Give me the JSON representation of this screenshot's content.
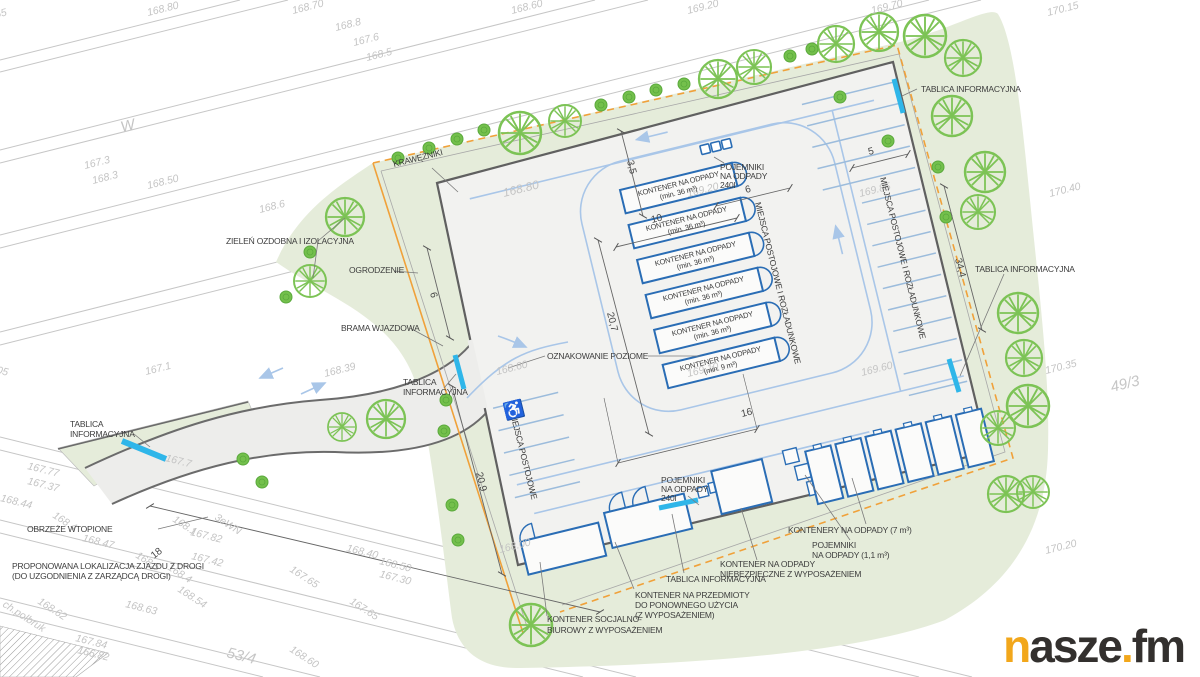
{
  "colors": {
    "green_area": "#e5ecda",
    "tree_stroke": "#7cc355",
    "bush_fill": "#74c04c",
    "yard_fill": "#f2f2f0",
    "driveway_fill": "#ededeb",
    "edge_dark": "#636363",
    "boundary_orange": "#f0a13a",
    "container_blue": "#2a6db5",
    "roadway_blue": "#a9c6e8",
    "stall_blue": "#9cbcdc",
    "sign_cyan": "#2fb6e9",
    "road_gray": "#c6c6c6",
    "elev_gray": "#c4c4c4",
    "ann_dark": "#3d3d3d",
    "logo_orange": "#f2a71b",
    "logo_dark": "#33302e"
  },
  "logo": {
    "n": "n",
    "asze": "asze",
    "dot": ".",
    "fm": "fm"
  },
  "plan": {
    "texts": [
      {
        "t": "65",
        "x": -4,
        "y": 18,
        "r": -14,
        "c": "e"
      },
      {
        "t": "168.80",
        "x": 148,
        "y": 16,
        "r": -14,
        "c": "e"
      },
      {
        "t": "168.70",
        "x": 293,
        "y": 14,
        "r": -14,
        "c": "e"
      },
      {
        "t": "168.8",
        "x": 336,
        "y": 31,
        "r": -14,
        "c": "e"
      },
      {
        "t": "167.6",
        "x": 354,
        "y": 46,
        "r": -14,
        "c": "e"
      },
      {
        "t": "168.5",
        "x": 367,
        "y": 61,
        "r": -14,
        "c": "e"
      },
      {
        "t": "168.60",
        "x": 512,
        "y": 14,
        "r": -14,
        "c": "e"
      },
      {
        "t": "169.20",
        "x": 688,
        "y": 14,
        "r": -14,
        "c": "e"
      },
      {
        "t": "169.70",
        "x": 872,
        "y": 14,
        "r": -14,
        "c": "e"
      },
      {
        "t": "170.15",
        "x": 1048,
        "y": 16,
        "r": -14,
        "c": "e"
      },
      {
        "t": "W",
        "x": 122,
        "y": 132,
        "r": -14,
        "s": 15,
        "c": "e"
      },
      {
        "t": "167.3",
        "x": 85,
        "y": 169,
        "r": -14,
        "c": "e"
      },
      {
        "t": "168.3",
        "x": 93,
        "y": 184,
        "r": -14,
        "c": "e"
      },
      {
        "t": "168.50",
        "x": 148,
        "y": 189,
        "r": -14,
        "c": "e"
      },
      {
        "t": "168.6",
        "x": 260,
        "y": 213,
        "r": -14,
        "c": "e"
      },
      {
        "t": "168.80",
        "x": 504,
        "y": 197,
        "r": -14,
        "s": 12,
        "c": "e"
      },
      {
        "t": "169.20",
        "x": 688,
        "y": 197,
        "r": -14,
        "c": "e"
      },
      {
        "t": "169.85",
        "x": 860,
        "y": 197,
        "r": -14,
        "c": "e"
      },
      {
        "t": "170.40",
        "x": 1050,
        "y": 197,
        "r": -14,
        "c": "e"
      },
      {
        "t": "168.39",
        "x": 325,
        "y": 377,
        "r": -14,
        "c": "e"
      },
      {
        "t": "167.1",
        "x": 146,
        "y": 375,
        "r": -14,
        "c": "e"
      },
      {
        "t": "168.60",
        "x": 497,
        "y": 375,
        "r": -14,
        "c": "e"
      },
      {
        "t": "169.10",
        "x": 688,
        "y": 377,
        "r": -14,
        "c": "e"
      },
      {
        "t": "169.60",
        "x": 862,
        "y": 376,
        "r": -14,
        "c": "e"
      },
      {
        "t": "170.35",
        "x": 1046,
        "y": 374,
        "r": -14,
        "c": "e"
      },
      {
        "t": "49/3",
        "x": 1112,
        "y": 392,
        "r": -14,
        "c": "p"
      },
      {
        "t": "170.20",
        "x": 1046,
        "y": 554,
        "r": -14,
        "c": "e"
      },
      {
        "t": "168.00",
        "x": 500,
        "y": 553,
        "r": -14,
        "c": "e"
      },
      {
        "t": "167.7",
        "x": 165,
        "y": 461,
        "r": 14,
        "c": "e"
      },
      {
        "t": "167.77",
        "x": 27,
        "y": 469,
        "r": 14,
        "c": "e"
      },
      {
        "t": "167.37",
        "x": 27,
        "y": 484,
        "r": 14,
        "c": "e"
      },
      {
        "t": "168.44",
        "x": 0,
        "y": 501,
        "r": 14,
        "c": "e"
      },
      {
        "t": "168.4",
        "x": 52,
        "y": 517,
        "r": 33,
        "c": "e"
      },
      {
        "t": "168.1",
        "x": 172,
        "y": 521,
        "r": 33,
        "c": "e"
      },
      {
        "t": "3eWN",
        "x": 214,
        "y": 519,
        "r": 33,
        "c": "e"
      },
      {
        "t": "167.82",
        "x": 190,
        "y": 535,
        "r": 14,
        "c": "e"
      },
      {
        "t": "167.42",
        "x": 191,
        "y": 559,
        "r": 14,
        "c": "e"
      },
      {
        "t": "168.47",
        "x": 82,
        "y": 541,
        "r": 14,
        "c": "e"
      },
      {
        "t": "168.5",
        "x": 135,
        "y": 557,
        "r": 33,
        "c": "e"
      },
      {
        "t": "168.4",
        "x": 167,
        "y": 569,
        "r": 33,
        "c": "e"
      },
      {
        "t": "168.54",
        "x": 177,
        "y": 591,
        "r": 33,
        "c": "e"
      },
      {
        "t": "168.63",
        "x": 125,
        "y": 607,
        "r": 14,
        "c": "e"
      },
      {
        "t": "168.62",
        "x": 37,
        "y": 603,
        "r": 33,
        "c": "e"
      },
      {
        "t": "ch.polbruk",
        "x": 2,
        "y": 606,
        "r": 33,
        "c": "e"
      },
      {
        "t": "167.84",
        "x": 75,
        "y": 641,
        "r": 14,
        "c": "e"
      },
      {
        "t": "166.82",
        "x": 77,
        "y": 653,
        "r": 14,
        "c": "e"
      },
      {
        "t": "53/4",
        "x": 226,
        "y": 657,
        "r": 14,
        "c": "p"
      },
      {
        "t": "168.60",
        "x": 289,
        "y": 651,
        "r": 33,
        "c": "e"
      },
      {
        "t": "167.65",
        "x": 289,
        "y": 571,
        "r": 33,
        "c": "e"
      },
      {
        "t": "167.65",
        "x": 349,
        "y": 603,
        "r": 33,
        "c": "e"
      },
      {
        "t": "168.40",
        "x": 346,
        "y": 551,
        "r": 14,
        "c": "e"
      },
      {
        "t": "168.50",
        "x": 379,
        "y": 564,
        "r": 14,
        "c": "e"
      },
      {
        "t": "167.30",
        "x": 379,
        "y": 577,
        "r": 14,
        "c": "e"
      },
      {
        "t": "05",
        "x": -4,
        "y": 373,
        "r": 14,
        "c": "e"
      },
      {
        "t": "KRAWĘŻNIKI",
        "x": 394,
        "y": 167,
        "r": -14,
        "c": "a"
      },
      {
        "t": "TABLICA INFORMACYJNA",
        "x": 921,
        "y": 92,
        "r": 0,
        "c": "a"
      },
      {
        "t": "ZIELEŃ OZDOBNA I IZOLACYJNA",
        "x": 226,
        "y": 244,
        "r": 0,
        "c": "a"
      },
      {
        "t": "OGRODZENIE",
        "x": 349,
        "y": 273,
        "r": 0,
        "c": "a"
      },
      {
        "t": "BRAMA WJAZDOWA",
        "x": 341,
        "y": 331,
        "r": 0,
        "c": "a"
      },
      {
        "t": "TABLICA",
        "x": 403,
        "y": 385,
        "r": 0,
        "c": "a"
      },
      {
        "t": "INFORMACYJNA",
        "x": 403,
        "y": 395,
        "r": 0,
        "c": "a"
      },
      {
        "t": "OZNAKOWANIE POZIOME",
        "x": 547,
        "y": 359,
        "r": 0,
        "c": "a"
      },
      {
        "t": "MIEJSCA POSTOJOWE",
        "x": 510,
        "y": 413,
        "r": 76,
        "c": "a"
      },
      {
        "t": "MIEJSCA POSTOJOWE I ROZŁADUNKOWE",
        "x": 755,
        "y": 203,
        "r": 76,
        "c": "a"
      },
      {
        "t": "MIEJSCA POSTOJOWE I ROZŁADUNKOWE",
        "x": 880,
        "y": 178,
        "r": 76,
        "c": "a"
      },
      {
        "t": "POJEMNIKI",
        "x": 720,
        "y": 170,
        "r": 0,
        "c": "a"
      },
      {
        "t": "NA ODPADY",
        "x": 720,
        "y": 179,
        "r": 0,
        "c": "a"
      },
      {
        "t": "240l",
        "x": 720,
        "y": 188,
        "r": 0,
        "c": "a"
      },
      {
        "t": "POJEMNIKI",
        "x": 661,
        "y": 483,
        "r": 0,
        "c": "a"
      },
      {
        "t": "NA ODPADY",
        "x": 661,
        "y": 492,
        "r": 0,
        "c": "a"
      },
      {
        "t": "240l",
        "x": 661,
        "y": 501,
        "r": 0,
        "c": "a"
      },
      {
        "t": "KONTENERY NA ODPADY (7 m³)",
        "x": 788,
        "y": 533,
        "r": 0,
        "c": "a"
      },
      {
        "t": "POJEMNIKI",
        "x": 812,
        "y": 548,
        "r": 0,
        "c": "a"
      },
      {
        "t": "NA ODPADY (1,1 m³)",
        "x": 812,
        "y": 558,
        "r": 0,
        "c": "a"
      },
      {
        "t": "KONTENER NA ODPADY",
        "x": 720,
        "y": 567,
        "r": 0,
        "c": "a"
      },
      {
        "t": "NIEBEZPIECZNE Z WYPOSAŻENIEM",
        "x": 720,
        "y": 577,
        "r": 0,
        "c": "a"
      },
      {
        "t": "TABLICA INFORMACYJNA",
        "x": 666,
        "y": 582,
        "r": 0,
        "c": "a"
      },
      {
        "t": "KONTENER NA PRZEDMIOTY",
        "x": 635,
        "y": 598,
        "r": 0,
        "c": "a"
      },
      {
        "t": "DO PONOWNEGO UŻYCIA",
        "x": 635,
        "y": 608,
        "r": 0,
        "c": "a"
      },
      {
        "t": "(Z WYPOSAŻENIEM)",
        "x": 635,
        "y": 618,
        "r": 0,
        "c": "a"
      },
      {
        "t": "KONTENER SOCJALNO-",
        "x": 547,
        "y": 622,
        "r": 0,
        "c": "a"
      },
      {
        "t": "BIUROWY Z WYPOSAŻENIEM",
        "x": 547,
        "y": 633,
        "r": 0,
        "c": "a"
      },
      {
        "t": "TABLICA",
        "x": 70,
        "y": 427,
        "r": 0,
        "c": "a"
      },
      {
        "t": "INFORMACYJNA",
        "x": 70,
        "y": 437,
        "r": 0,
        "c": "a"
      },
      {
        "t": "TABLICA INFORMACYJNA",
        "x": 975,
        "y": 272,
        "r": 0,
        "c": "a"
      },
      {
        "t": "OBRZEŻE WTOPIONE",
        "x": 27,
        "y": 532,
        "r": 0,
        "c": "a"
      },
      {
        "t": "PROPONOWANA LOKALIZACJA ZJAZDU Z DROGI",
        "x": 12,
        "y": 569,
        "r": 0,
        "c": "a"
      },
      {
        "t": "(DO UZGODNIENIA Z ZARZĄDCĄ DROGI)",
        "x": 12,
        "y": 579,
        "r": 0,
        "c": "a"
      },
      {
        "t": "KONTENER NA ODPADY",
        "x": 679,
        "y": 186,
        "r": -14,
        "s": 7.5,
        "a": "m",
        "c": "a"
      },
      {
        "t": "(min. 36 m³)",
        "x": 679,
        "y": 195,
        "r": -14,
        "s": 7.5,
        "a": "m",
        "c": "a"
      },
      {
        "t": "KONTENER NA ODPADY",
        "x": 687,
        "y": 221,
        "r": -14,
        "s": 7.5,
        "a": "m",
        "c": "a"
      },
      {
        "t": "(min. 36 m³)",
        "x": 687,
        "y": 230,
        "r": -14,
        "s": 7.5,
        "a": "m",
        "c": "a"
      },
      {
        "t": "KONTENER NA ODPADY",
        "x": 696,
        "y": 256,
        "r": -14,
        "s": 7.5,
        "a": "m",
        "c": "a"
      },
      {
        "t": "(min. 36 m³)",
        "x": 696,
        "y": 265,
        "r": -14,
        "s": 7.5,
        "a": "m",
        "c": "a"
      },
      {
        "t": "KONTENER NA ODPADY",
        "x": 704,
        "y": 291,
        "r": -14,
        "s": 7.5,
        "a": "m",
        "c": "a"
      },
      {
        "t": "(min. 36 m³)",
        "x": 704,
        "y": 300,
        "r": -14,
        "s": 7.5,
        "a": "m",
        "c": "a"
      },
      {
        "t": "KONTENER NA ODPADY",
        "x": 713,
        "y": 326,
        "r": -14,
        "s": 7.5,
        "a": "m",
        "c": "a"
      },
      {
        "t": "(min. 36 m³)",
        "x": 713,
        "y": 335,
        "r": -14,
        "s": 7.5,
        "a": "m",
        "c": "a"
      },
      {
        "t": "KONTENER NA ODPADY",
        "x": 721,
        "y": 361,
        "r": -14,
        "s": 7.5,
        "a": "m",
        "c": "a"
      },
      {
        "t": "(min. 9 m³)",
        "x": 721,
        "y": 370,
        "r": -14,
        "s": 7.5,
        "a": "m",
        "c": "a"
      },
      {
        "t": "3,5",
        "x": 627,
        "y": 161,
        "r": 76,
        "c": "d"
      },
      {
        "t": "10",
        "x": 652,
        "y": 223,
        "r": -14,
        "c": "d"
      },
      {
        "t": "6",
        "x": 746,
        "y": 193,
        "r": -14,
        "c": "d"
      },
      {
        "t": "20,7",
        "x": 607,
        "y": 313,
        "r": 76,
        "c": "d"
      },
      {
        "t": "16",
        "x": 742,
        "y": 417,
        "r": -14,
        "c": "d"
      },
      {
        "t": "5",
        "x": 869,
        "y": 155,
        "r": -14,
        "c": "d"
      },
      {
        "t": "34,4",
        "x": 955,
        "y": 259,
        "r": 76,
        "c": "d"
      },
      {
        "t": "20,9",
        "x": 476,
        "y": 473,
        "r": 76,
        "c": "d"
      },
      {
        "t": "6",
        "x": 430,
        "y": 293,
        "r": 76,
        "c": "d"
      },
      {
        "t": "18",
        "x": 154,
        "y": 559,
        "r": -38,
        "c": "d"
      },
      {
        "t": "♿",
        "x": 505,
        "y": 418,
        "r": -14,
        "c": "i"
      }
    ]
  }
}
